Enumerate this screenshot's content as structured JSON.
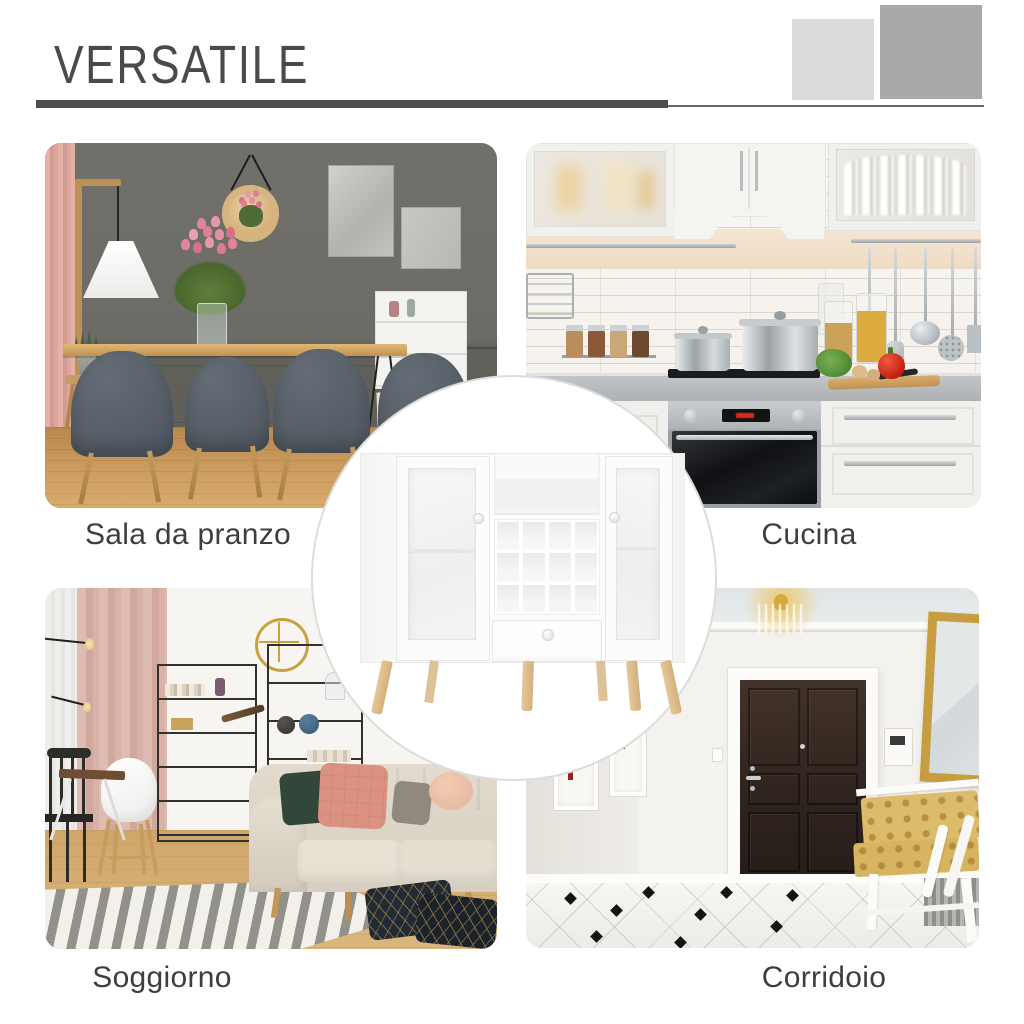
{
  "page": {
    "background_color": "#ffffff"
  },
  "header": {
    "title": "VERSATILE",
    "title_color": "#4a4a4a",
    "underline_bar_color": "#4d4d4d",
    "underline_line_color": "#686868",
    "accent_squares": [
      {
        "name": "light-gray-square",
        "color": "#dbdbdb"
      },
      {
        "name": "medium-gray-square",
        "color": "#a9a9a9"
      }
    ]
  },
  "rooms": [
    {
      "id": "dining-room",
      "label": "Sala da pranzo",
      "position": "top-left"
    },
    {
      "id": "kitchen",
      "label": "Cucina",
      "position": "top-right"
    },
    {
      "id": "living-room",
      "label": "Soggiorno",
      "position": "bottom-left"
    },
    {
      "id": "hallway",
      "label": "Corridoio",
      "position": "bottom-right"
    }
  ],
  "labels": {
    "color": "#3e3e3e"
  },
  "center_product": {
    "image": "white-sideboard-wine-rack-cabinet-with-glass-doors-and-wood-legs",
    "background_color": "#ffffff",
    "ring_color": "#dcdcdc"
  }
}
